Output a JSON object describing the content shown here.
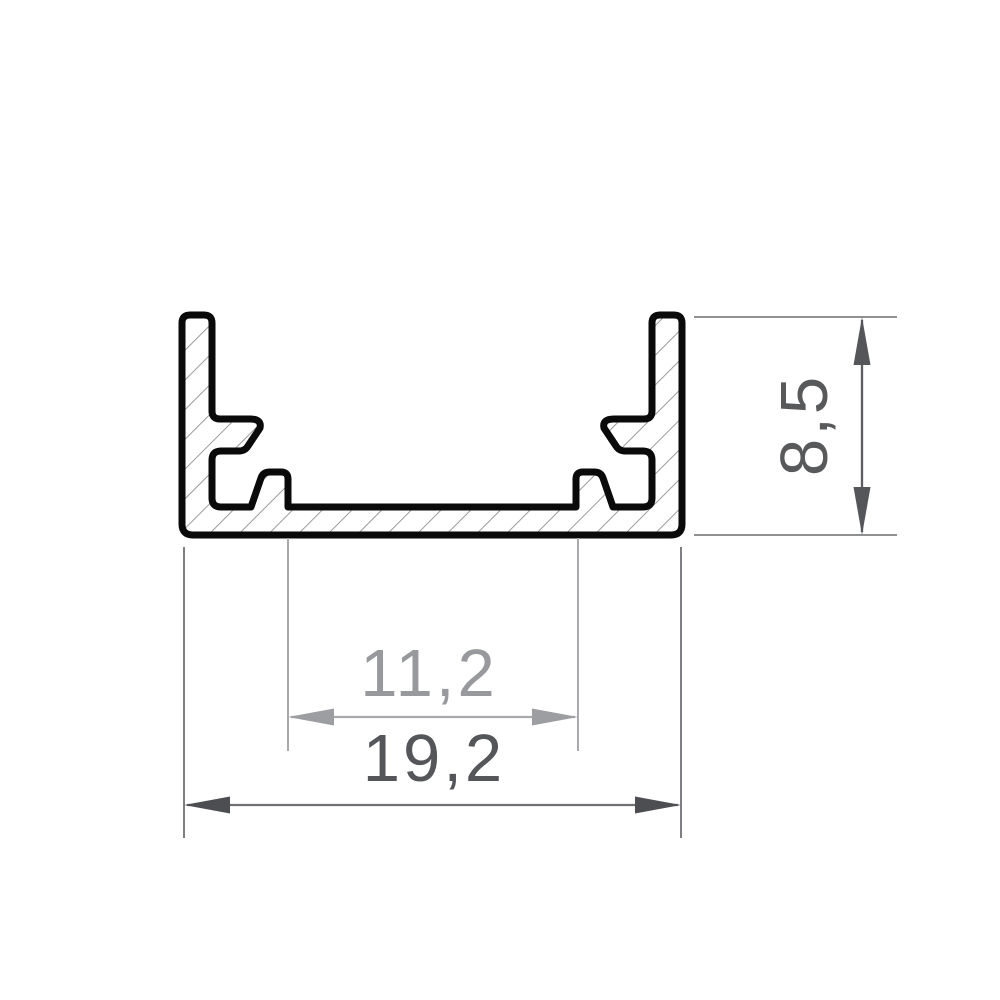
{
  "diagram": {
    "type": "technical-drawing-cross-section",
    "subject": "aluminum-led-profile-u-channel",
    "background": "#ffffff",
    "profile": {
      "outline_color": "#0a0a0a",
      "outline_stroke_px": 7,
      "hatch_color": "#9a9b9e",
      "hatch_angle_deg": 45,
      "body_fill": "#ffffff"
    },
    "dimensions": {
      "height": {
        "label": "8,5",
        "value": 8.5,
        "orientation": "vertical",
        "side": "right",
        "text_color": "#58595b",
        "line_color": "#5c5d60",
        "ext_line_color": "#8f9193"
      },
      "inner_width": {
        "label": "11,2",
        "value": 11.2,
        "orientation": "horizontal",
        "side": "bottom",
        "text_color": "#97999d",
        "line_color": "#a8aaad",
        "ext_line_color": "#a8aaad"
      },
      "outer_width": {
        "label": "19,2",
        "value": 19.2,
        "orientation": "horizontal",
        "side": "bottom",
        "text_color": "#54565a",
        "line_color": "#6f7073",
        "ext_line_color": "#7d7f82"
      }
    }
  }
}
